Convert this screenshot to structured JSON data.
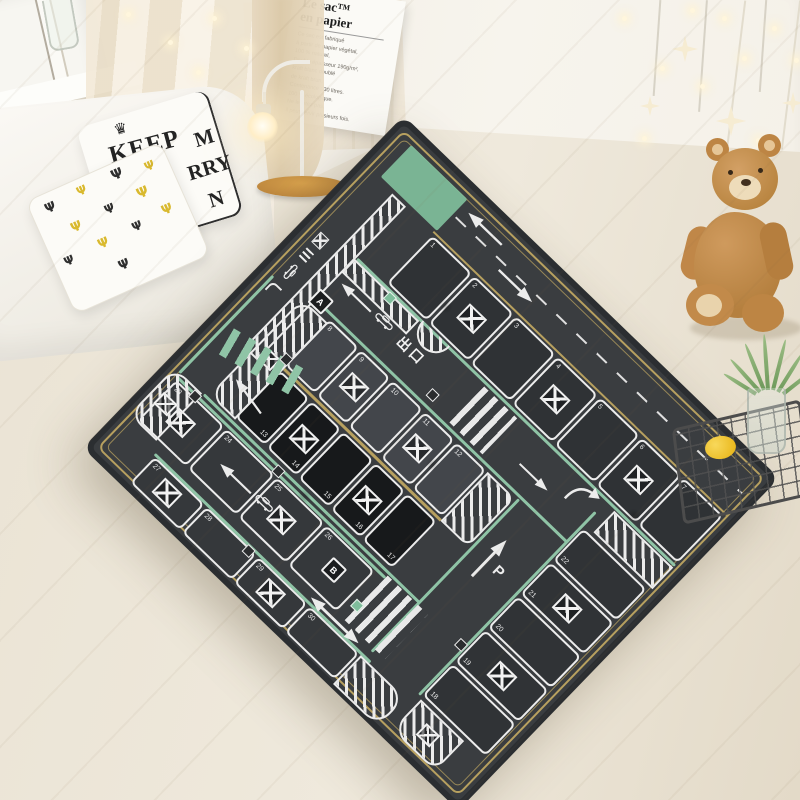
{
  "room": {
    "poster": {
      "title_line1": "Le sac™",
      "title_line2": "en papier",
      "body_lines": [
        "Ce sac est fabriqué",
        "à partir de papier végétal,",
        "100 % naturel,",
        "Double épaisseur 190g/m²,",
        "kraft blanc doublé",
        "de kraft brun.",
        "Contenance : 30 litres.",
        "100 % écologique.",
        "Ne le jetez pas,",
        "il peut servir plusieurs fois."
      ]
    },
    "pillow": {
      "fragments": [
        "KEEP",
        "M",
        "RRY",
        "N"
      ]
    },
    "colors": {
      "wall": "#f2eee5",
      "floor": "#e8e1d3",
      "curtain": "#e9ddc4",
      "teddy": "#c08a50",
      "lemon": "#eebd24"
    }
  },
  "rug": {
    "exit_label": "出口",
    "zone_labels": {
      "a": "A",
      "b": "B"
    },
    "parking_symbol": "P",
    "rows": [
      {
        "name": "row-1-7",
        "spots": [
          {
            "n": "1"
          },
          {
            "n": "2",
            "crossed": true
          },
          {
            "n": "3"
          },
          {
            "n": "4",
            "crossed": true
          },
          {
            "n": "5"
          },
          {
            "n": "6",
            "crossed": true
          },
          {
            "n": "7"
          }
        ]
      },
      {
        "name": "row-8-12",
        "spots": [
          {
            "n": "8"
          },
          {
            "n": "9",
            "crossed": true
          },
          {
            "n": "10"
          },
          {
            "n": "11",
            "crossed": true
          },
          {
            "n": "12"
          }
        ]
      },
      {
        "name": "row-13-17",
        "spots": [
          {
            "n": "13"
          },
          {
            "n": "14",
            "crossed": true
          },
          {
            "n": "15"
          },
          {
            "n": "16",
            "crossed": true
          },
          {
            "n": "17"
          }
        ]
      },
      {
        "name": "row-18-22",
        "spots": [
          {
            "n": "18"
          },
          {
            "n": "19",
            "crossed": true
          },
          {
            "n": "20"
          },
          {
            "n": "21",
            "crossed": true
          },
          {
            "n": "22"
          }
        ]
      },
      {
        "name": "row-23-26",
        "spots": [
          {
            "n": "23",
            "crossed": true
          },
          {
            "n": "24"
          },
          {
            "n": "25",
            "crossed": true
          },
          {
            "n": "26"
          }
        ]
      },
      {
        "name": "row-27-30",
        "spots": [
          {
            "n": "27",
            "crossed": true
          },
          {
            "n": "28"
          },
          {
            "n": "29",
            "crossed": true
          },
          {
            "n": "30"
          }
        ]
      }
    ],
    "colors": {
      "base": "#3a3d40",
      "spot_dark": "#17191b",
      "spot_light": "#43464b",
      "line_white": "#ececec",
      "green": "#8fc4a6",
      "entry_green": "#7fbd9b",
      "gold": "#b7a05f"
    }
  },
  "icons": {
    "crown": "♛",
    "cactus": "Ψ"
  }
}
